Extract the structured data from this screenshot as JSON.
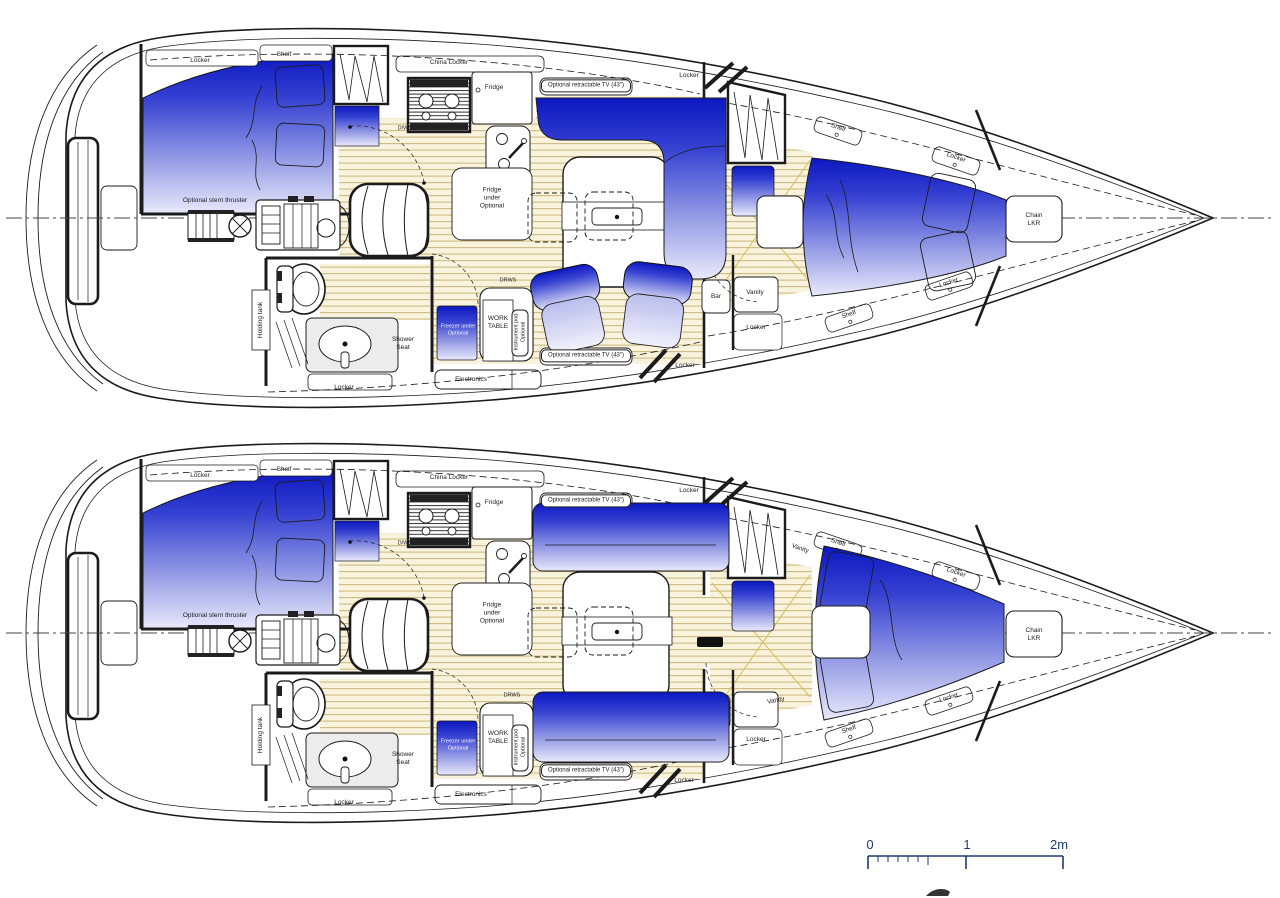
{
  "labels": {
    "locker": "Locker",
    "shelf": "Shelf",
    "china_locker": "China Locker",
    "fridge": "Fridge",
    "optional_tv": "Optional retractable TV (43\")",
    "dwd": "D/WD",
    "drws": "DRWS",
    "fridge_under": "Fridge\nunder\nOptional",
    "freezer_under": "Freezer under\nOptional",
    "work_table": "WORK\nTABLE",
    "instrument_pod": "Instrument pod\nOptional",
    "electronics": "Electronics",
    "shower_seat": "Shower\nSeat",
    "holding_tank": "Holding tank",
    "stern_thruster": "Optional stern thruster",
    "bar": "Bar",
    "vanity": "Vanity",
    "chain_locker": "Chain\nLKR"
  },
  "scale_bar": {
    "tick_0": "0",
    "tick_1": "1",
    "tick_2": "2m"
  },
  "colors": {
    "upholstery_dark": "#0c17c0",
    "upholstery_light": "#e9e9fb",
    "floor": "#f9f3de",
    "floor_stripe": "#ccbc80",
    "outline": "#1b1b1b",
    "scale_bar": "#1d3b6f"
  }
}
